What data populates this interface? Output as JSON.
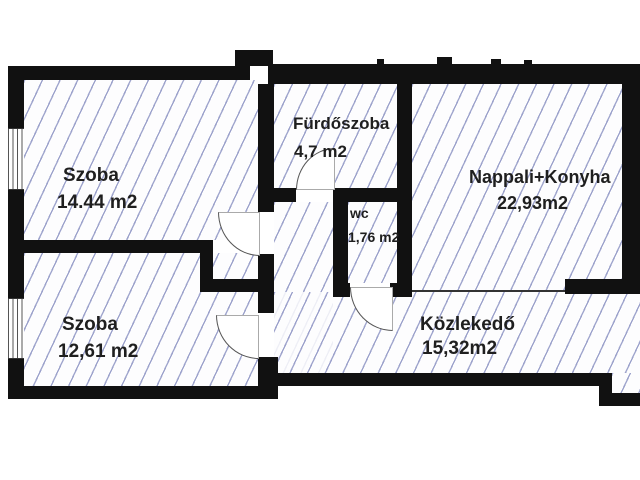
{
  "drawing_type": "apartment-floor-plan",
  "rooms": [
    {
      "id": "szoba-1",
      "name": "Szoba",
      "area": "14.44 m2"
    },
    {
      "id": "szoba-2",
      "name": "Szoba",
      "area": "12,61 m2"
    },
    {
      "id": "furdoszoba",
      "name": "Fürdőszoba",
      "area": "4,7 m2"
    },
    {
      "id": "wc",
      "name": "wc",
      "area": "1,76 m2"
    },
    {
      "id": "nappali",
      "name": "Nappali+Konyha",
      "area": "22,93m2"
    },
    {
      "id": "kozlekedo",
      "name": "Közlekedő",
      "area": "15,32m2"
    }
  ],
  "colors": {
    "wall": "#111111",
    "hatch": "#8d93c4",
    "floor": "#fdfdfe",
    "text": "#1f1f1f",
    "door": "#555555"
  }
}
